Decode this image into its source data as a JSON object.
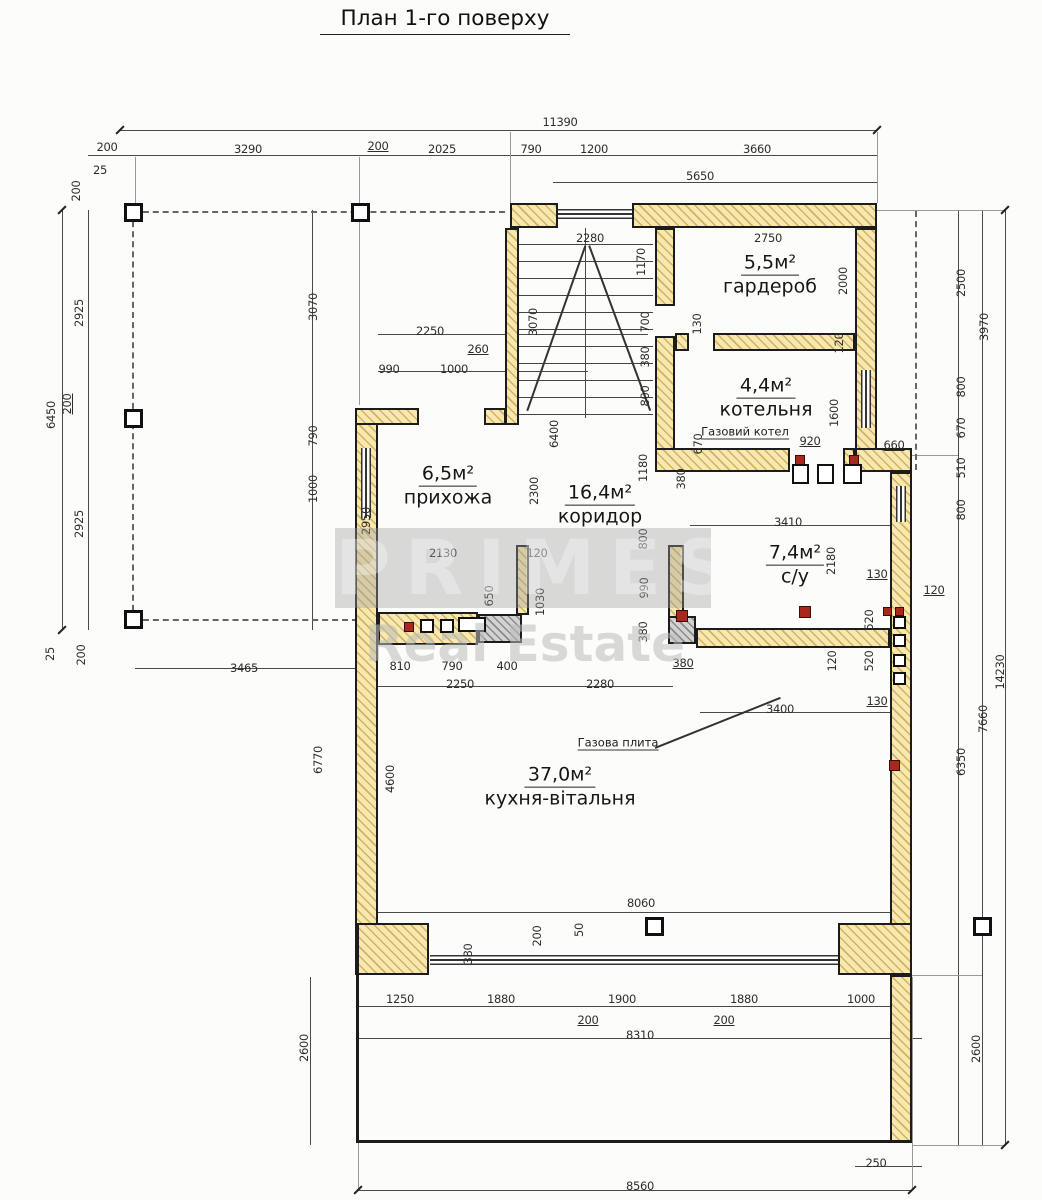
{
  "title": "План 1-го поверху",
  "watermark": {
    "brand": "PRIMES",
    "subtitle": "Real Estate"
  },
  "rooms": [
    {
      "area": "5,5м²",
      "name": "гардероб"
    },
    {
      "area": "4,4м²",
      "name": "котельня"
    },
    {
      "area": "6,5м²",
      "name": "прихожа"
    },
    {
      "area": "16,4м²",
      "name": "коридор"
    },
    {
      "area": "7,4м²",
      "name": "с/у"
    },
    {
      "area": "37,0м²",
      "name": "кухня-вітальня"
    }
  ],
  "annotations": {
    "boiler": "Газовий котел",
    "stove": "Газова плита"
  },
  "colors": {
    "wall_fill": "#f6e8ae",
    "wall_hatch": "#d2b164",
    "line": "#4a4a4a",
    "fixture_red": "#a8281e",
    "watermark_gray": "#9e9e9e"
  },
  "dimensions": [
    {
      "t": "11390",
      "x": 560,
      "y": 122
    },
    {
      "t": "200",
      "x": 107,
      "y": 147
    },
    {
      "t": "25",
      "x": 100,
      "y": 170
    },
    {
      "t": "3290",
      "x": 248,
      "y": 149
    },
    {
      "t": "200",
      "x": 378,
      "y": 146,
      "u": true
    },
    {
      "t": "2025",
      "x": 442,
      "y": 149
    },
    {
      "t": "790",
      "x": 531,
      "y": 149
    },
    {
      "t": "1200",
      "x": 594,
      "y": 149
    },
    {
      "t": "3660",
      "x": 757,
      "y": 149
    },
    {
      "t": "5650",
      "x": 700,
      "y": 176
    },
    {
      "t": "200",
      "x": 76,
      "y": 191,
      "v": true
    },
    {
      "t": "2925",
      "x": 79,
      "y": 313,
      "v": true
    },
    {
      "t": "6450",
      "x": 51,
      "y": 415,
      "v": true
    },
    {
      "t": "200",
      "x": 67,
      "y": 404,
      "v": true,
      "u": true
    },
    {
      "t": "2925",
      "x": 79,
      "y": 524,
      "v": true
    },
    {
      "t": "25",
      "x": 50,
      "y": 654,
      "v": true
    },
    {
      "t": "200",
      "x": 81,
      "y": 655,
      "v": true
    },
    {
      "t": "3465",
      "x": 244,
      "y": 668
    },
    {
      "t": "3070",
      "x": 313,
      "y": 307,
      "v": true
    },
    {
      "t": "790",
      "x": 313,
      "y": 436,
      "v": true
    },
    {
      "t": "1000",
      "x": 313,
      "y": 489,
      "v": true
    },
    {
      "t": "2250",
      "x": 430,
      "y": 331
    },
    {
      "t": "260",
      "x": 478,
      "y": 349,
      "u": true
    },
    {
      "t": "990",
      "x": 389,
      "y": 369
    },
    {
      "t": "1000",
      "x": 454,
      "y": 369
    },
    {
      "t": "2280",
      "x": 590,
      "y": 238
    },
    {
      "t": "3070",
      "x": 533,
      "y": 322,
      "v": true
    },
    {
      "t": "1170",
      "x": 641,
      "y": 262,
      "v": true
    },
    {
      "t": "700",
      "x": 645,
      "y": 322,
      "v": true
    },
    {
      "t": "380",
      "x": 645,
      "y": 357,
      "v": true
    },
    {
      "t": "800",
      "x": 645,
      "y": 396,
      "v": true
    },
    {
      "t": "6400",
      "x": 554,
      "y": 434,
      "v": true
    },
    {
      "t": "2750",
      "x": 768,
      "y": 238
    },
    {
      "t": "2000",
      "x": 843,
      "y": 281,
      "v": true
    },
    {
      "t": "130",
      "x": 697,
      "y": 324,
      "v": true
    },
    {
      "t": "120",
      "x": 839,
      "y": 343,
      "v": true
    },
    {
      "t": "1600",
      "x": 834,
      "y": 413,
      "v": true
    },
    {
      "t": "670",
      "x": 698,
      "y": 444,
      "v": true
    },
    {
      "t": "380",
      "x": 681,
      "y": 479,
      "v": true
    },
    {
      "t": "920",
      "x": 810,
      "y": 441,
      "u": true
    },
    {
      "t": "660",
      "x": 894,
      "y": 445,
      "u": true
    },
    {
      "t": "2500",
      "x": 961,
      "y": 283,
      "v": true
    },
    {
      "t": "3970",
      "x": 984,
      "y": 327,
      "v": true
    },
    {
      "t": "800",
      "x": 961,
      "y": 387,
      "v": true
    },
    {
      "t": "670",
      "x": 961,
      "y": 428,
      "v": true
    },
    {
      "t": "510",
      "x": 961,
      "y": 468,
      "v": true
    },
    {
      "t": "800",
      "x": 961,
      "y": 510,
      "v": true
    },
    {
      "t": "120",
      "x": 934,
      "y": 590,
      "u": true
    },
    {
      "t": "14230",
      "x": 1000,
      "y": 672,
      "v": true
    },
    {
      "t": "7660",
      "x": 983,
      "y": 719,
      "v": true
    },
    {
      "t": "6350",
      "x": 961,
      "y": 762,
      "v": true
    },
    {
      "t": "2600",
      "x": 976,
      "y": 1049,
      "v": true
    },
    {
      "t": "3410",
      "x": 788,
      "y": 522
    },
    {
      "t": "2180",
      "x": 831,
      "y": 561,
      "v": true
    },
    {
      "t": "130",
      "x": 877,
      "y": 574,
      "u": true
    },
    {
      "t": "520",
      "x": 869,
      "y": 620,
      "v": true
    },
    {
      "t": "120",
      "x": 832,
      "y": 661,
      "v": true
    },
    {
      "t": "520",
      "x": 869,
      "y": 661,
      "v": true
    },
    {
      "t": "130",
      "x": 877,
      "y": 701,
      "u": true
    },
    {
      "t": "380",
      "x": 683,
      "y": 663,
      "u": true
    },
    {
      "t": "3400",
      "x": 780,
      "y": 709
    },
    {
      "t": "2950",
      "x": 366,
      "y": 521,
      "v": true
    },
    {
      "t": "2130",
      "x": 443,
      "y": 553
    },
    {
      "t": "120",
      "x": 537,
      "y": 553
    },
    {
      "t": "650",
      "x": 489,
      "y": 596,
      "v": true
    },
    {
      "t": "1030",
      "x": 540,
      "y": 602,
      "v": true
    },
    {
      "t": "2300",
      "x": 534,
      "y": 491,
      "v": true
    },
    {
      "t": "1180",
      "x": 643,
      "y": 468,
      "v": true
    },
    {
      "t": "800",
      "x": 643,
      "y": 539,
      "v": true
    },
    {
      "t": "990",
      "x": 644,
      "y": 588,
      "v": true
    },
    {
      "t": "380",
      "x": 643,
      "y": 632,
      "v": true
    },
    {
      "t": "810",
      "x": 400,
      "y": 666
    },
    {
      "t": "790",
      "x": 452,
      "y": 666
    },
    {
      "t": "400",
      "x": 507,
      "y": 666
    },
    {
      "t": "2250",
      "x": 460,
      "y": 684
    },
    {
      "t": "2280",
      "x": 600,
      "y": 684
    },
    {
      "t": "6770",
      "x": 318,
      "y": 760,
      "v": true
    },
    {
      "t": "4600",
      "x": 390,
      "y": 779,
      "v": true
    },
    {
      "t": "8060",
      "x": 641,
      "y": 903
    },
    {
      "t": "380",
      "x": 468,
      "y": 954,
      "v": true
    },
    {
      "t": "200",
      "x": 537,
      "y": 936,
      "v": true
    },
    {
      "t": "50",
      "x": 579,
      "y": 930,
      "v": true
    },
    {
      "t": "1250",
      "x": 400,
      "y": 999
    },
    {
      "t": "1880",
      "x": 501,
      "y": 999
    },
    {
      "t": "1900",
      "x": 622,
      "y": 999
    },
    {
      "t": "1880",
      "x": 744,
      "y": 999
    },
    {
      "t": "1000",
      "x": 861,
      "y": 999
    },
    {
      "t": "200",
      "x": 588,
      "y": 1020,
      "u": true
    },
    {
      "t": "200",
      "x": 724,
      "y": 1020,
      "u": true
    },
    {
      "t": "8310",
      "x": 640,
      "y": 1035
    },
    {
      "t": "2600",
      "x": 304,
      "y": 1048,
      "v": true
    },
    {
      "t": "8560",
      "x": 640,
      "y": 1186
    },
    {
      "t": "250",
      "x": 876,
      "y": 1163
    }
  ]
}
